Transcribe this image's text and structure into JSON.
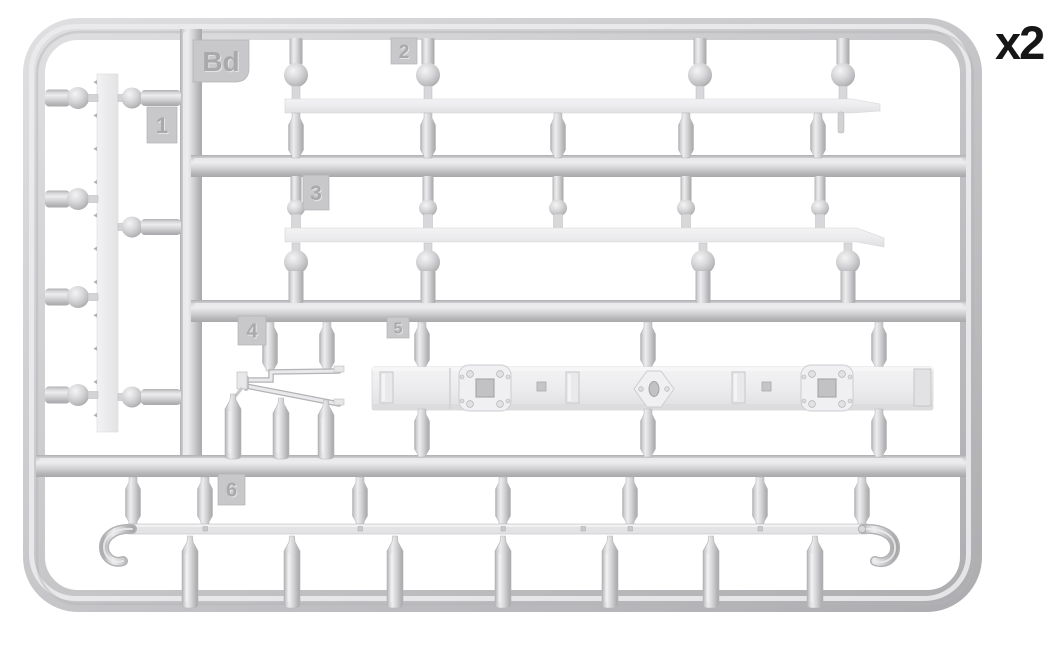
{
  "page": {
    "background": "#ffffff"
  },
  "illustration": {
    "type": "model-kit-sprue-diagram",
    "quantity_label": "x2",
    "sprue_code": "Bd",
    "part_numbers": [
      "1",
      "2",
      "3",
      "4",
      "5",
      "6"
    ],
    "colors": {
      "plastic": "#cccccd",
      "plastic_dark": "#a8a8ab",
      "plastic_light": "#ededef",
      "part_white": "#ededee",
      "tag": "#c8c8cb",
      "label_text": "#161616"
    }
  }
}
